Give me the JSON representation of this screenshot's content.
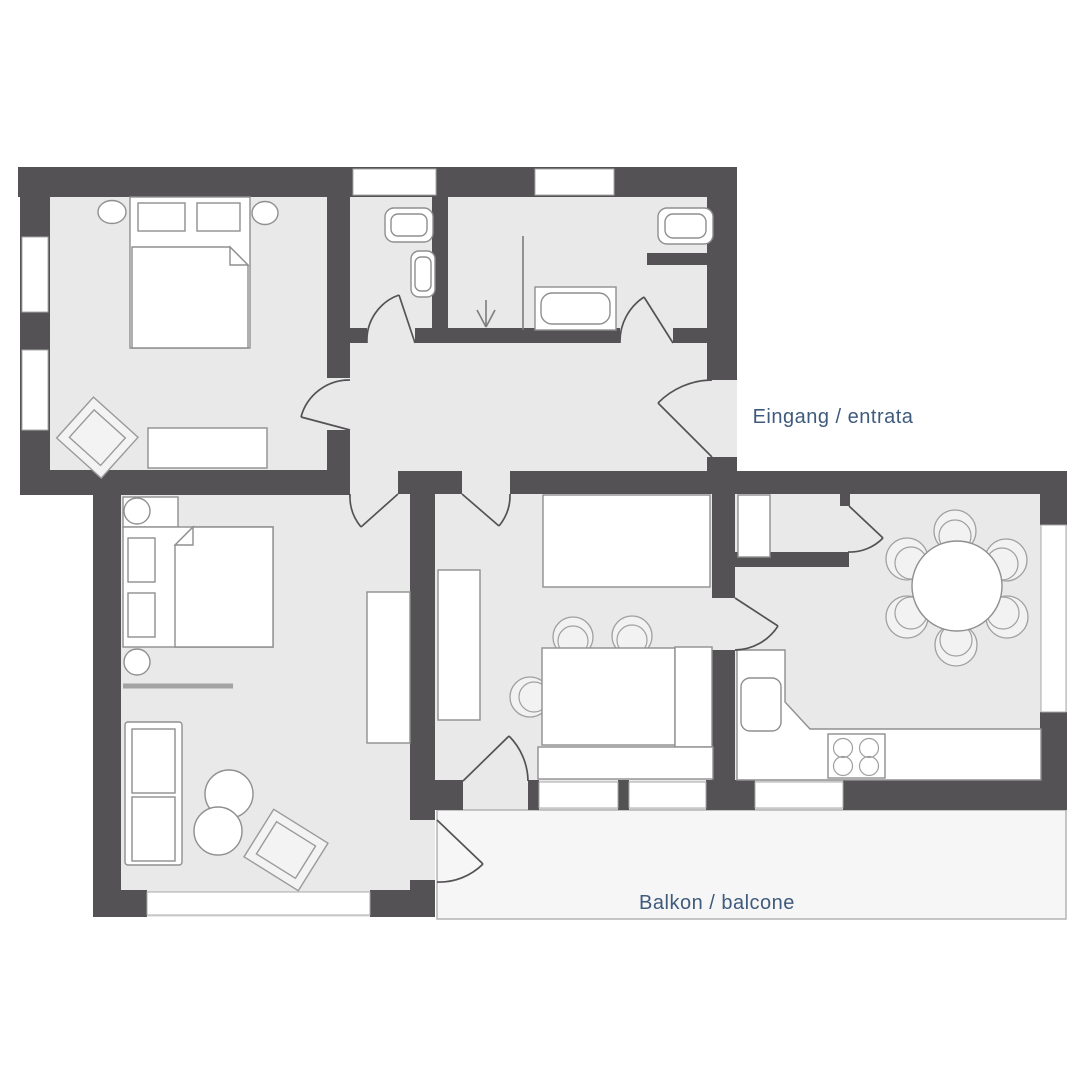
{
  "plan": {
    "labels": {
      "entrance": "Eingang / entrata",
      "balcony": "Balkon / balcone"
    },
    "palette": {
      "wall": "#545254",
      "room_floor": "#e9e9ea",
      "balcony_floor": "#f6f6f6",
      "furniture_fill": "#ffffff",
      "furniture_stroke": "#8f8f8f",
      "door_stroke": "#545254",
      "window_fill": "#ffffff",
      "label_color": "#3e5a7c",
      "background": "#ffffff"
    }
  }
}
